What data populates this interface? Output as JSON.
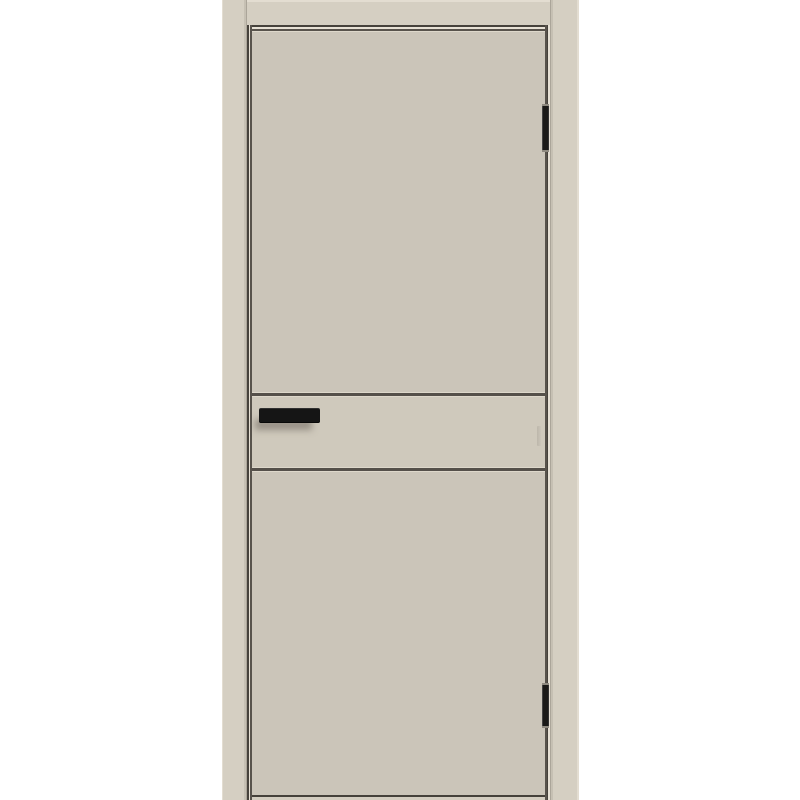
{
  "image": {
    "type": "product-photo",
    "subject": "flush interior door in light greige finish with black rectangular pull handle, two horizontal grooves across the leaf, two black hinges on the right edge and matching door frame casing",
    "hinge_side": "right",
    "text_content": ""
  },
  "colors": {
    "background": "#ffffff",
    "casing": "#d5cfc2",
    "casing_highlight": "#e3ddd1",
    "casing_shade": "#c6c0b3",
    "casing_joint": "#aba599",
    "leaf": "#cbc5b9",
    "band": "#cfc9bc",
    "reveal_dark": "#46423b",
    "reveal_dark2": "#58534c",
    "reveal_light": "#e7e1d5",
    "groove_dark": "#55504a",
    "groove_light": "#ded8cb",
    "handle": "#151515",
    "handle_shadow": "rgba(105,99,90,0.55)",
    "hinge": "#1b1a18",
    "hinge_cap": "#8f8a80",
    "latch": "#bdb7ab",
    "bottom_edge": "#45413a",
    "bottom_strip": "#d3cdc0"
  },
  "parts": {
    "frame_left": "left frame casing",
    "frame_right": "right frame casing",
    "frame_head": "head frame casing",
    "leaf": "door leaf",
    "groove_upper": "upper horizontal groove",
    "groove_lower": "lower horizontal groove",
    "mid_band": "middle leaf band",
    "handle": "black bar pull handle",
    "latch": "latch strike on right edge",
    "hinge_top": "top hinge",
    "hinge_bottom": "bottom hinge",
    "bottom": "door bottom edge"
  }
}
